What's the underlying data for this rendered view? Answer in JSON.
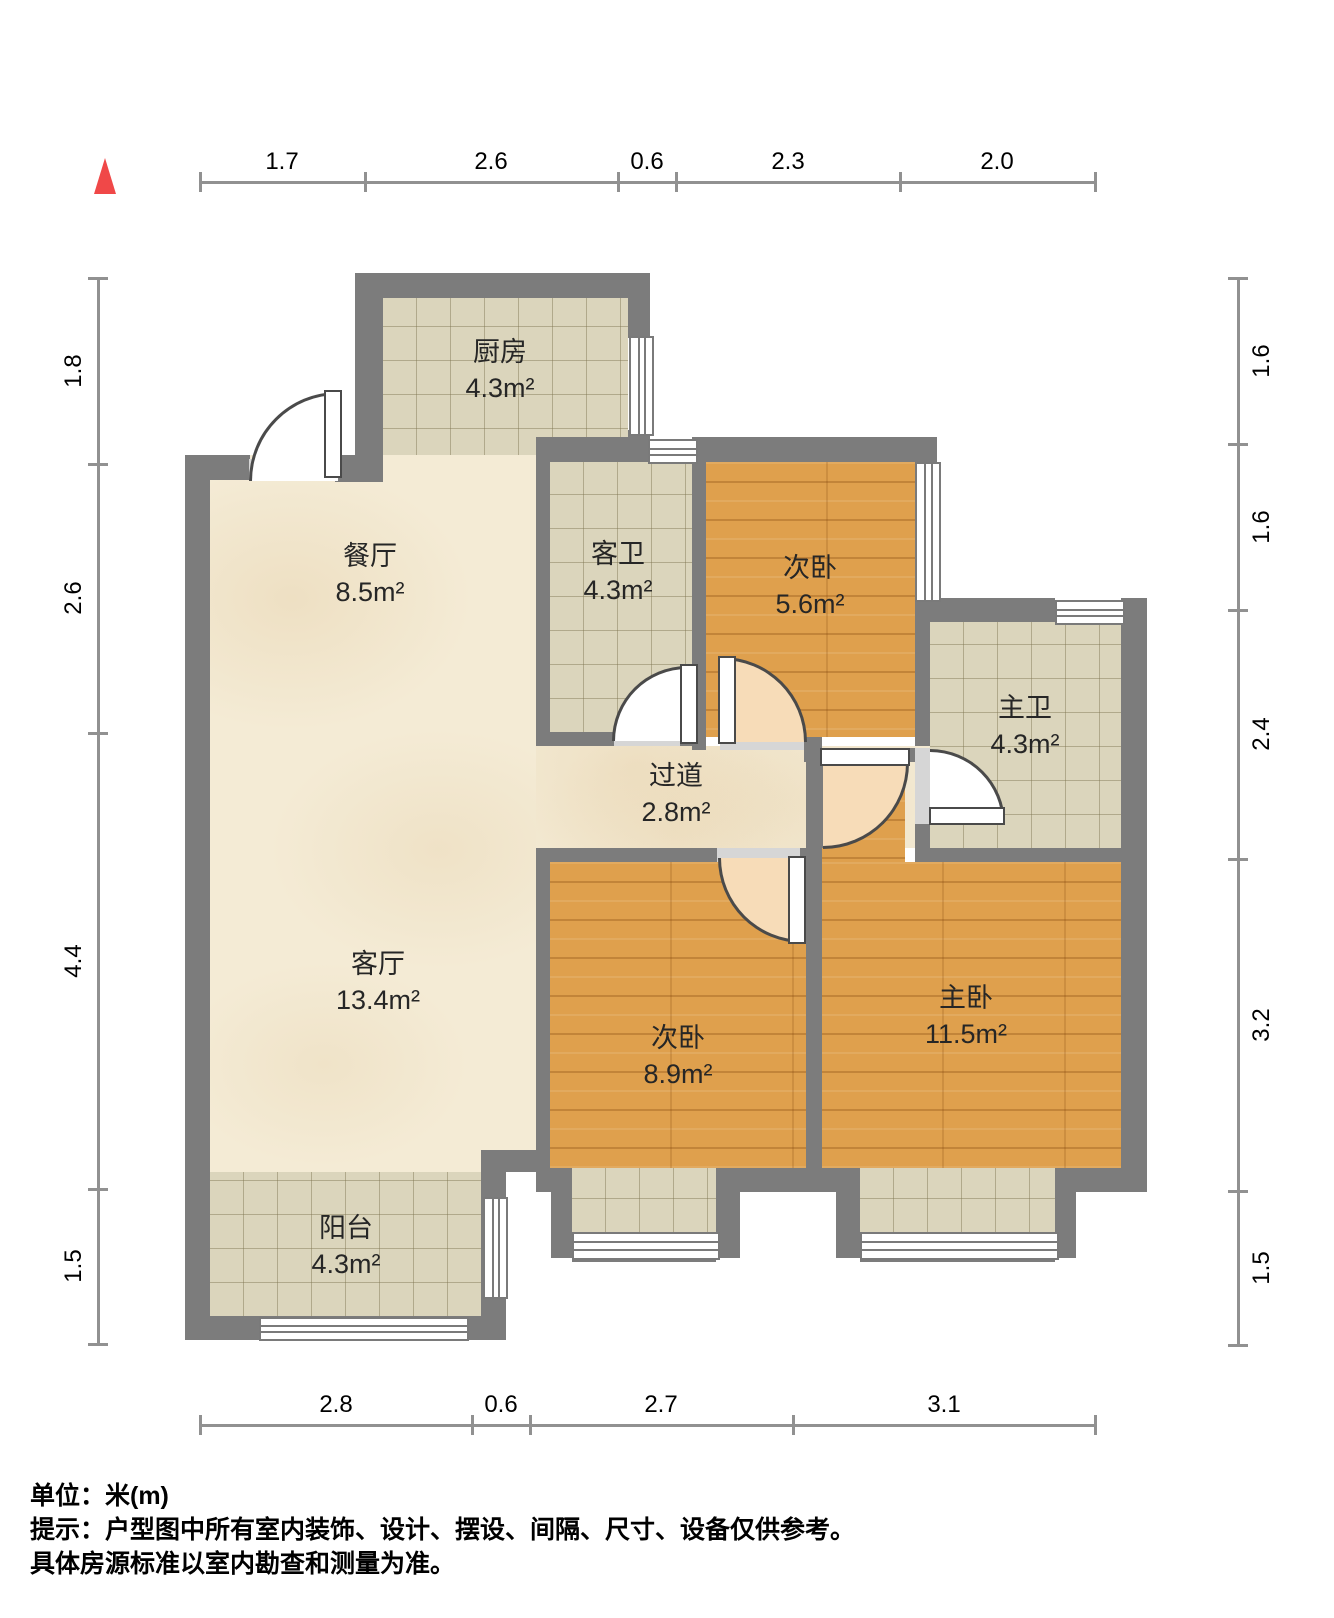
{
  "icons": {
    "north": "north-arrow-icon"
  },
  "dimensions": {
    "top": {
      "s1": "1.7",
      "s2": "2.6",
      "s3": "0.6",
      "s4": "2.3",
      "s5": "2.0"
    },
    "bottom": {
      "s1": "2.8",
      "s2": "0.6",
      "s3": "2.7",
      "s4": "3.1"
    },
    "left": {
      "s1": "1.8",
      "s2": "2.6",
      "s3": "4.4",
      "s4": "1.5"
    },
    "right": {
      "s1": "1.6",
      "s2": "1.6",
      "s3": "2.4",
      "s4": "3.2",
      "s5": "1.5"
    }
  },
  "rooms": {
    "kitchen": {
      "name": "厨房",
      "area": "4.3m²"
    },
    "dining": {
      "name": "餐厅",
      "area": "8.5m²"
    },
    "guest_bath": {
      "name": "客卫",
      "area": "4.3m²"
    },
    "bedroom_small": {
      "name": "次卧",
      "area": "5.6m²"
    },
    "master_bath": {
      "name": "主卫",
      "area": "4.3m²"
    },
    "hallway": {
      "name": "过道",
      "area": "2.8m²"
    },
    "living": {
      "name": "客厅",
      "area": "13.4m²"
    },
    "bedroom_mid": {
      "name": "次卧",
      "area": "8.9m²"
    },
    "master_bedroom": {
      "name": "主卧",
      "area": "11.5m²"
    },
    "balcony": {
      "name": "阳台",
      "area": "4.3m²"
    }
  },
  "notes": {
    "unit": "单位：米(m)",
    "tip_line1": "提示：户型图中所有室内装饰、设计、摆设、间隔、尺寸、设备仅供参考。",
    "tip_line2": "具体房源标准以室内勘查和测量为准。"
  },
  "colors": {
    "wall": "#7c7c7c",
    "wood_floor": "#dfa04d",
    "tile_floor": "#dbd5bc",
    "marble_floor": "#f4ebd5",
    "door_swing": "#f7dcb8",
    "north_arrow": "#f04848"
  }
}
